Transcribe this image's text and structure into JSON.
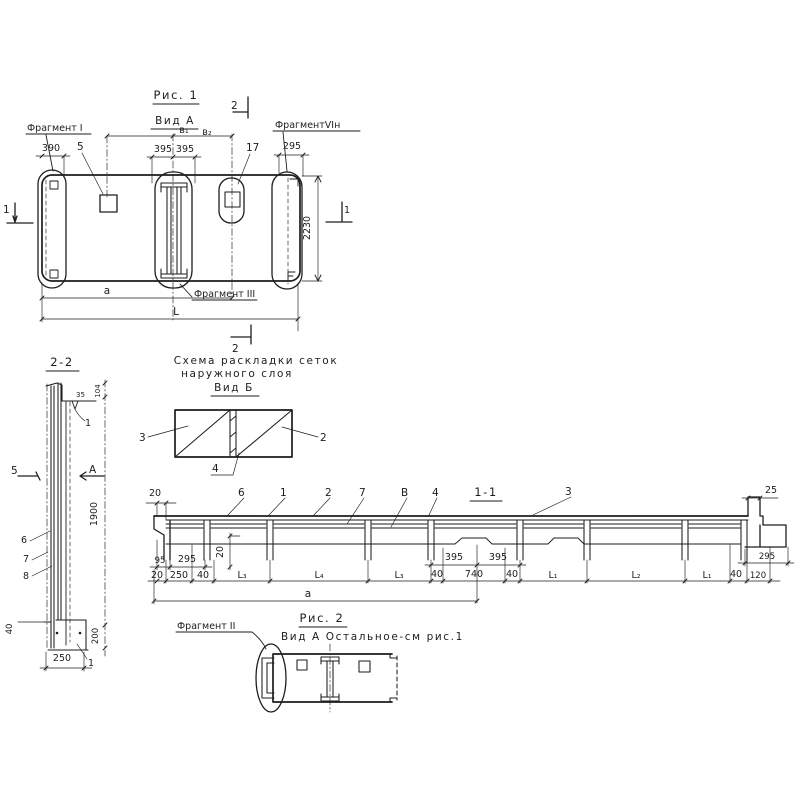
{
  "colors": {
    "ink": "#1d1d1d",
    "paper": "#ffffff"
  },
  "figure1": {
    "title": "Рис. 1",
    "view": "Вид А",
    "marker_top": "2",
    "marker_bottom": "2",
    "marker_left": "1",
    "marker_right": "1",
    "fragment_left": "Фрагмент I",
    "fragment_right": "ФрагментVIн",
    "fragment_mid": "Фрагмент III",
    "dim_390": "390",
    "label_5": "5",
    "dim_b1": "в₁",
    "dim_b2": "в₂",
    "dim_395a": "395",
    "dim_395b": "395",
    "label_17": "17",
    "dim_295": "295",
    "dim_2230": "2230",
    "dim_a": "а",
    "dim_L": "L"
  },
  "section22": {
    "title": "2-2",
    "dim_104": "104",
    "label_35": "35",
    "label_1_top": "1",
    "marker_5": "5",
    "marker_a": "А",
    "dim_1900": "1900",
    "label_6": "6",
    "label_7": "7",
    "label_8": "8",
    "dim_40": "40",
    "dim_200": "200",
    "dim_250": "250",
    "label_1_bottom": "1"
  },
  "mesh_schema": {
    "title_line1": "Схема раскладки сеток",
    "title_line2": "наружного слоя",
    "view": "Вид Б",
    "label_3": "3",
    "label_2": "2",
    "label_4": "4"
  },
  "section11": {
    "title": "1-1",
    "dim_20_top": "20",
    "dim_25": "25",
    "labels_top": [
      "6",
      "1",
      "2",
      "7",
      "В",
      "4",
      "3"
    ],
    "dim_95": "95",
    "dim_295_left": "295",
    "dim_20_vert": "20",
    "dim_395a": "395",
    "dim_395b": "395",
    "dim_295_right": "295",
    "dims_bottom": [
      "20",
      "250",
      "40",
      "L₃",
      "L₄",
      "L₃",
      "40",
      "740",
      "40",
      "L₁",
      "L₂",
      "L₁",
      "40",
      "120"
    ],
    "dim_a": "а"
  },
  "figure2": {
    "title": "Рис. 2",
    "subtitle": "Вид А Остальное-см рис.1",
    "fragment": "Фрагмент II"
  }
}
